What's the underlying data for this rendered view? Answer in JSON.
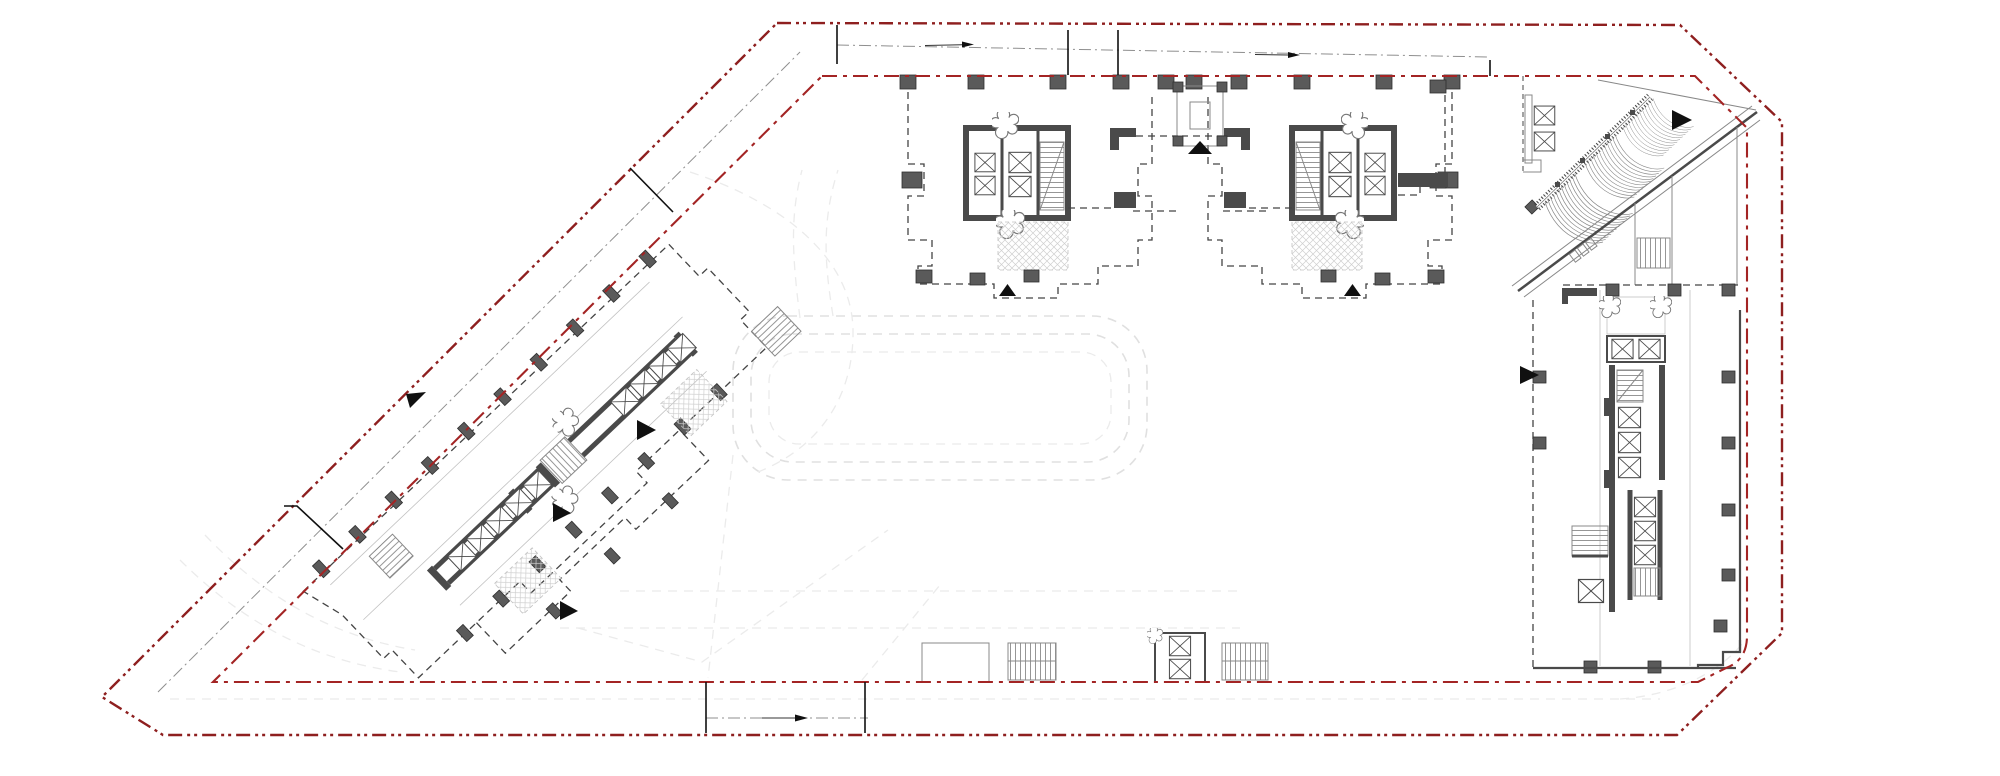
{
  "page": {
    "title": "Architectural site and floor plan drawing",
    "canvas_width": 2000,
    "canvas_height": 776,
    "background": "#ffffff"
  },
  "colors": {
    "bg": "#ffffff",
    "boundaryOuter": "#8e1f1f",
    "boundaryInner": "#a32424",
    "centerline": "#8f8f8f",
    "road": "#e0e0e0",
    "roadSoft": "#ebebeb",
    "wall": "#4a4a4a",
    "column": "#5a5a5a",
    "columnEdge": "#2f2f2f",
    "thin": "#888888",
    "light": "#c2c2c2",
    "dashEdge": "#444444",
    "arrow": "#101010",
    "stairLine": "#8a8a8a",
    "hatchLine": "#cfcfcf"
  },
  "components": [
    {
      "id": "site-boundary-outer",
      "kind": "red phantom line (dash-dot-dot) site limit"
    },
    {
      "id": "site-boundary-inner",
      "kind": "red dash-dot setback line"
    },
    {
      "id": "road-centerlines",
      "kind": "gray dash-dot access centerlines with flow arrows"
    },
    {
      "id": "internal-loop-road",
      "kind": "light dashed courtyard loop road"
    },
    {
      "id": "tower-core-west",
      "kind": "tower footprint with elevator core and stair"
    },
    {
      "id": "tower-core-east",
      "kind": "mirrored tower footprint with elevator core and stair"
    },
    {
      "id": "between-towers-stair",
      "kind": "square stair shaft"
    },
    {
      "id": "diagonal-slab-building",
      "kind": "rotated slab building with elevator banks and stairs"
    },
    {
      "id": "east-building",
      "kind": "east podium with elevator core and stairs"
    },
    {
      "id": "fan-canopy",
      "kind": "fanned ramp canopy with escalator band and elevators"
    },
    {
      "id": "south-service-blocks",
      "kind": "stair blocks and elevator pair on south edge"
    },
    {
      "id": "entrance-markers",
      "kind": "solid black triangle markers"
    }
  ],
  "counts": {
    "entrance_triangles": 8,
    "flow_arrows": 4,
    "boundary_gate_ticks": 8,
    "tower_cores": 2
  }
}
